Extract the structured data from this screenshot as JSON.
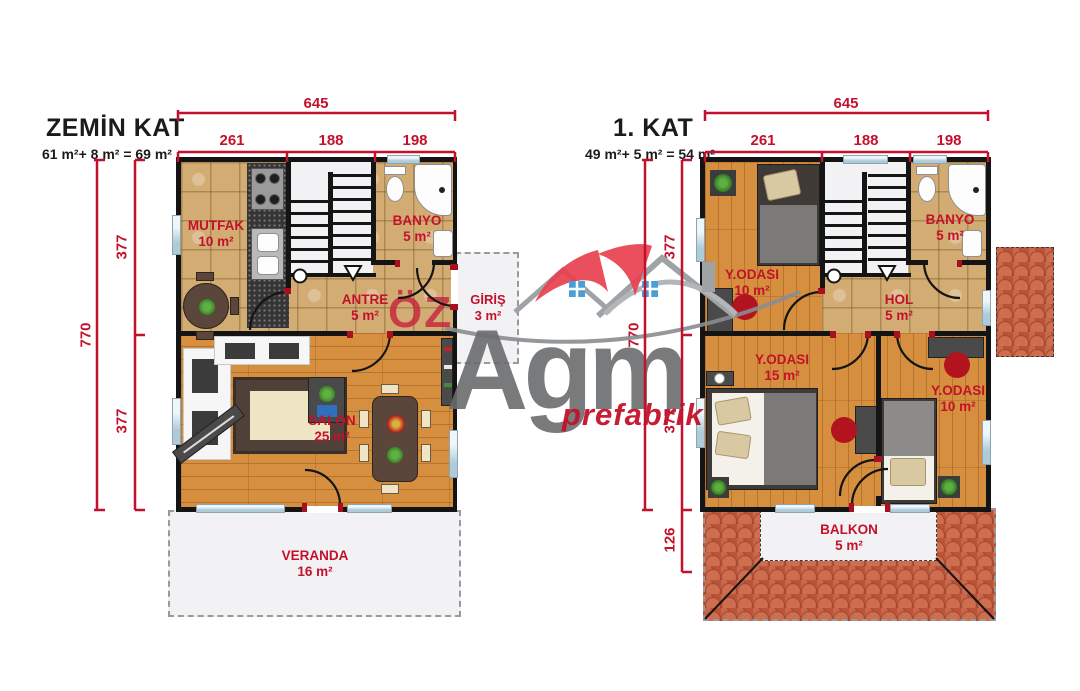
{
  "watermark": {
    "oz": "ÖZ",
    "brand": "Agm",
    "tagline": "prefabrik"
  },
  "colors": {
    "dimension_red": "#c3112b",
    "room_label_red": "#c3112b",
    "wall_black": "#141414",
    "wood_floor": "#d68e3f",
    "tile_floor": "#d3ac74",
    "marble_white": "#f2f2f4",
    "roof_terracotta": "#bc5339",
    "logo_gray": "#6b6c6e",
    "logo_red": "#e8404f",
    "window_blue": "#cfe3ec"
  },
  "floors": [
    {
      "id": "zemin-kat",
      "title": "ZEMİN KAT",
      "area_formula": "61 m²+ 8 m² = 69 m²",
      "dims": {
        "total_w": "645",
        "w_segments": [
          "261",
          "188",
          "198"
        ],
        "total_h": "770",
        "h_segments": [
          "377",
          "377"
        ]
      },
      "rooms": [
        {
          "name": "MUTFAK",
          "area": "10 m²"
        },
        {
          "name": "BANYO",
          "area": "5 m²"
        },
        {
          "name": "ANTRE",
          "area": "5 m²"
        },
        {
          "name": "GİRİŞ",
          "area": "3 m²"
        },
        {
          "name": "SALON",
          "area": "25 m²"
        },
        {
          "name": "VERANDA",
          "area": "16 m²"
        }
      ]
    },
    {
      "id": "birinci-kat",
      "title": "1. KAT",
      "area_formula": "49 m²+ 5 m² = 54 m²",
      "dims": {
        "total_w": "645",
        "w_segments": [
          "261",
          "188",
          "198"
        ],
        "total_h": "770",
        "h_segments": [
          "377",
          "377",
          "126"
        ]
      },
      "rooms": [
        {
          "name": "Y.ODASI",
          "area": "10 m²"
        },
        {
          "name": "BANYO",
          "area": "5 m²"
        },
        {
          "name": "HOL",
          "area": "5 m²"
        },
        {
          "name": "Y.ODASI",
          "area": "15 m²"
        },
        {
          "name": "Y.ODASI",
          "area": "10 m²"
        },
        {
          "name": "BALKON",
          "area": "5 m²"
        }
      ]
    }
  ]
}
